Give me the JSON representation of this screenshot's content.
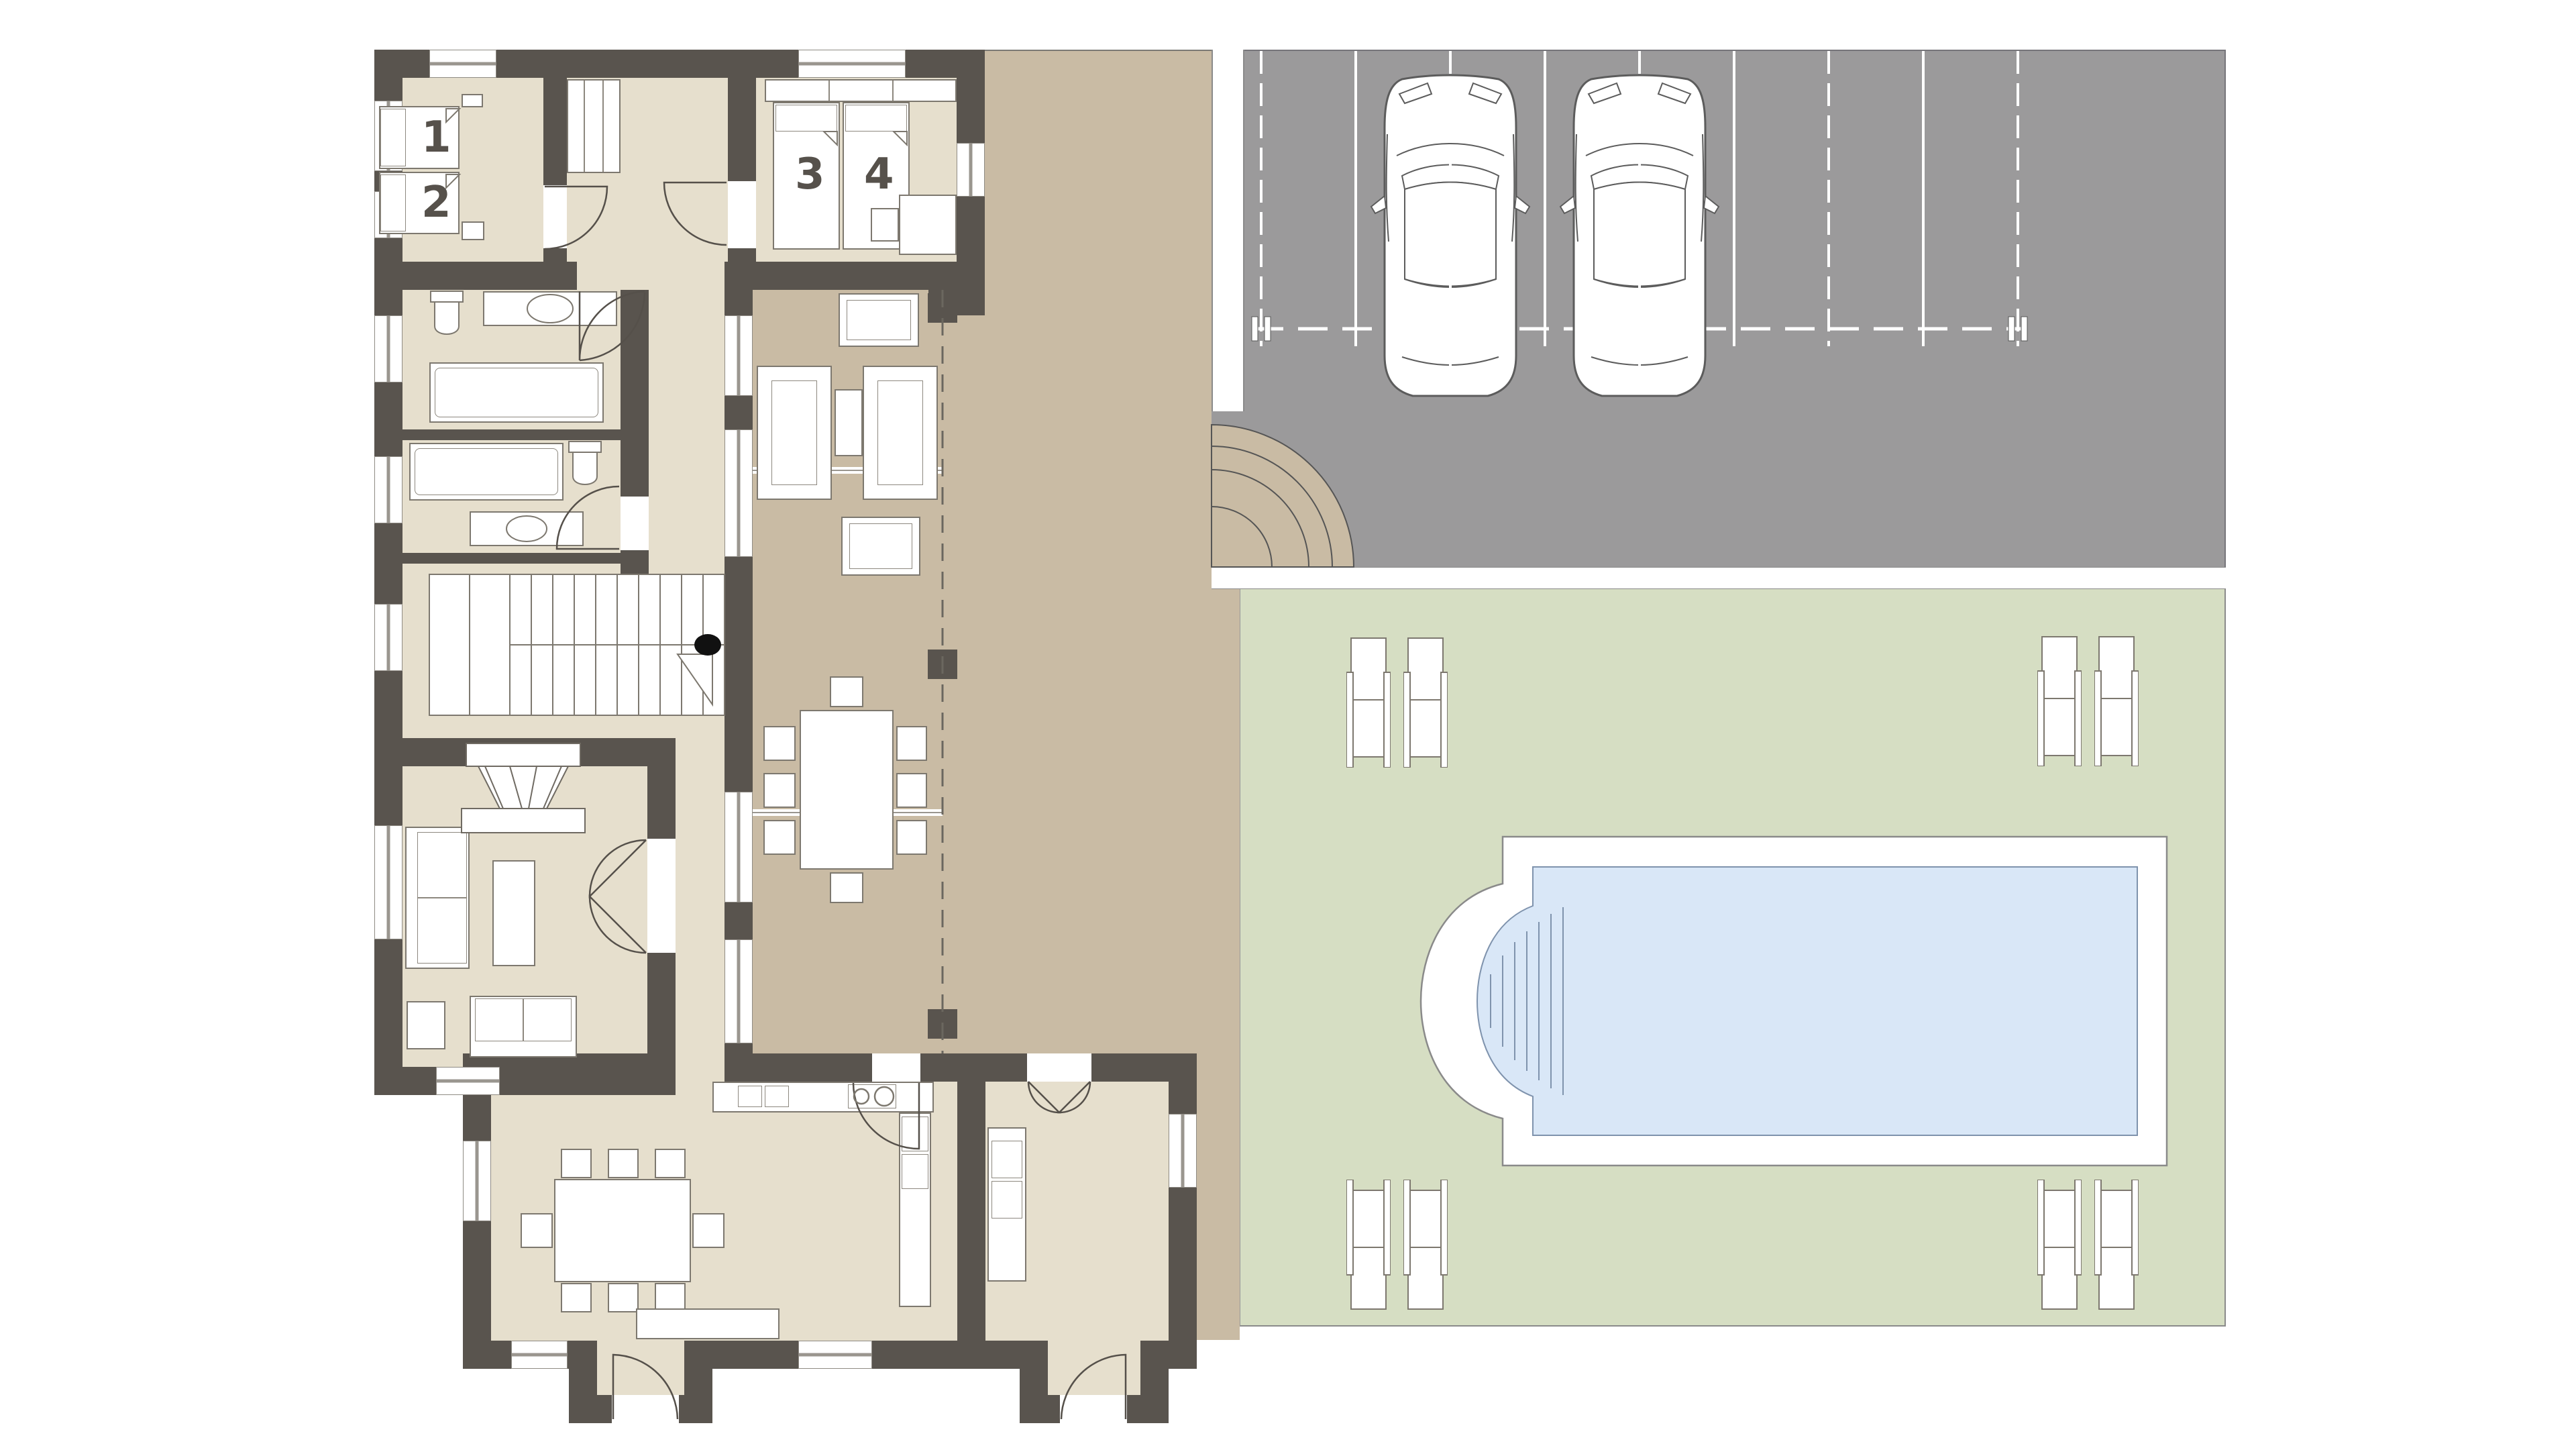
{
  "plan": {
    "type": "residential floor plan with pool, lawn and parking",
    "room_labels": {
      "bed1": "1",
      "bed2": "2",
      "bed3": "3",
      "bed4": "4"
    },
    "colors": {
      "background": "#ffffff",
      "wall": "#59544e",
      "interior_floor": "#e6dfcd",
      "terrace": "#c9bba4",
      "parking_asphalt": "#9b9a9b",
      "lawn": "#d6dec3",
      "pool_water": "#d9e7f7",
      "pool_deck": "#ffffff",
      "marking_lines": "#ffffff",
      "label_text": "#56514b"
    },
    "site": {
      "cars_parked": 2,
      "parking_bay_lines": 9,
      "sun_loungers": 8,
      "pool_has_step_end": true,
      "curved_steps_corner": true,
      "loggia_columns": 3
    },
    "rooms": [
      "bedroom-1-2",
      "bedroom-3-4",
      "hall",
      "bathroom-a",
      "bathroom-b",
      "stair-hall",
      "living-room",
      "corridor",
      "kitchen-dining",
      "garage-store",
      "entry-vestibule-main",
      "entry-vestibule-side",
      "loggia",
      "terrace",
      "parking",
      "lawn",
      "pool"
    ]
  }
}
